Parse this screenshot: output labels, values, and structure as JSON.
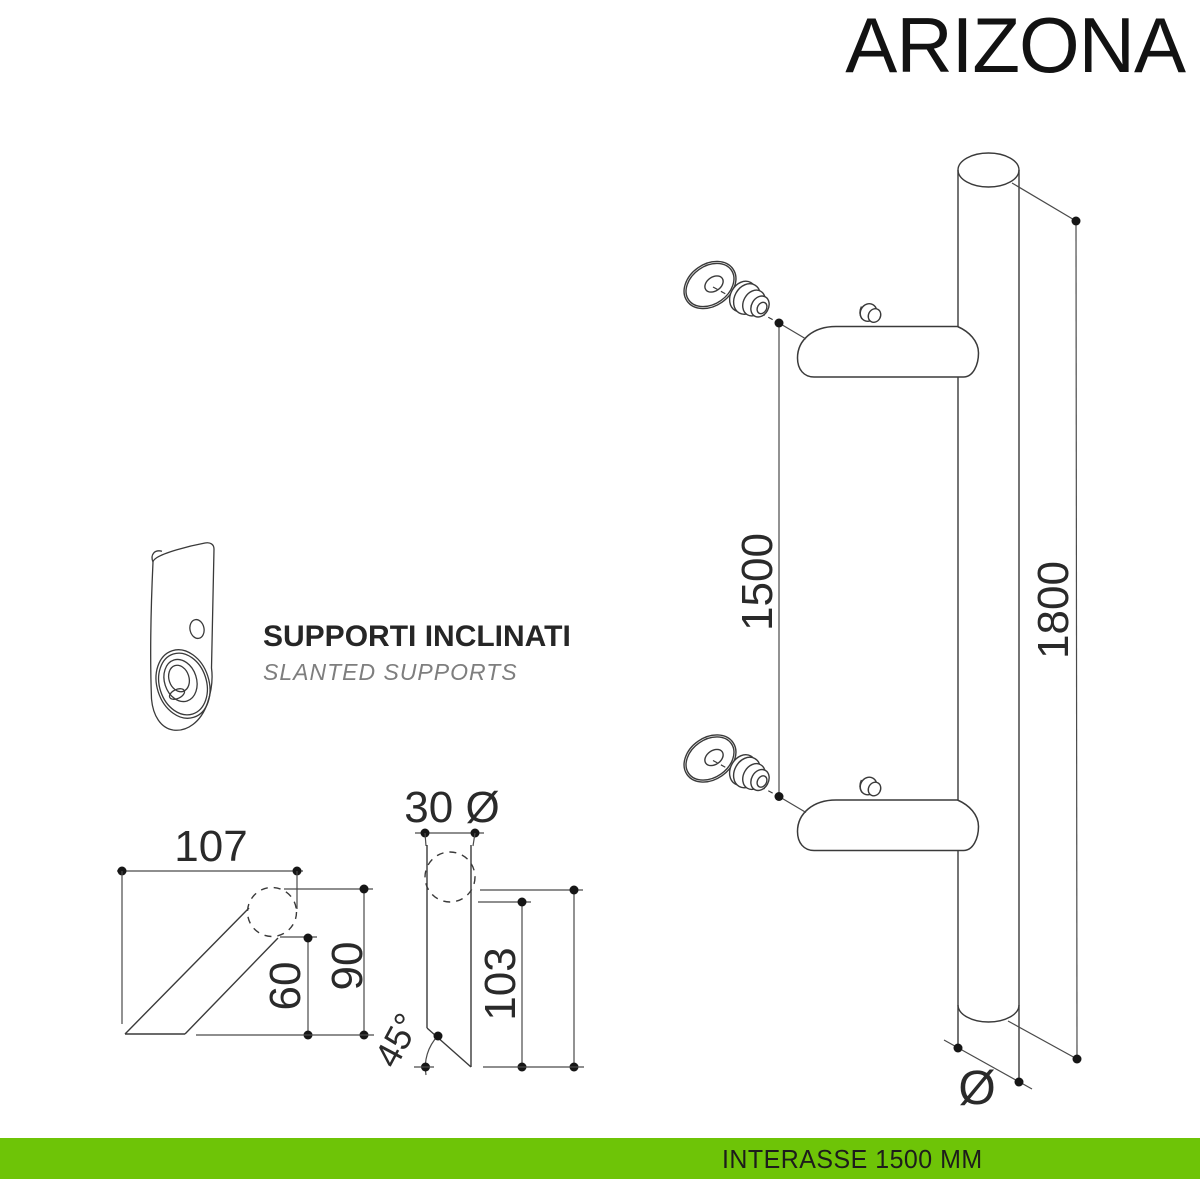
{
  "title": "ARIZONA",
  "note": {
    "title": "SUPPORTI INCLINATI",
    "subtitle": "SLANTED SUPPORTS"
  },
  "footer": {
    "label": "INTERASSE 1500 MM"
  },
  "colors": {
    "accent_green": "#6ec407",
    "line": "#3a3a3a",
    "text": "#1d1d1b"
  },
  "dimensions": {
    "interaxis": "1500",
    "overall_length": "1800",
    "support_projection": "107",
    "support_height_total": "90",
    "support_height_partial": "60",
    "tube_diameter": "30 Ø",
    "support_length_partial": "103",
    "support_length_total": "110",
    "chamfer_angle": "45°",
    "diameter_symbol": "Ø"
  }
}
